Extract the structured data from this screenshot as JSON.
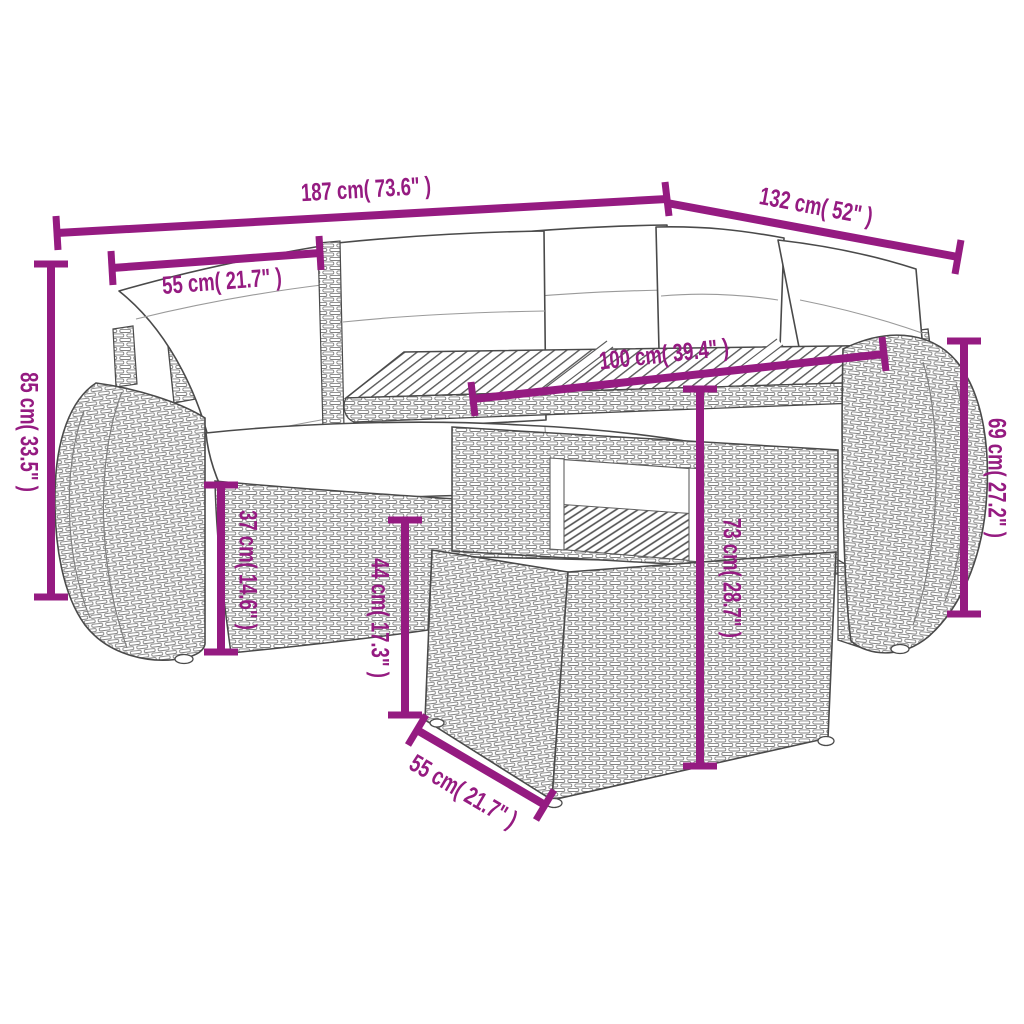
{
  "accent_color": "#951b81",
  "sketch_color": "#4a4a4a",
  "artwork_description": "Grayscale line drawing of a 5-piece poly rattan garden lounge set: corner sofa with back pillows and seat cushions, table with slatted wood top and under-shelf, and a footstool ottoman",
  "dims": {
    "d187": "187 cm( 73.6\" )",
    "d132": "132 cm( 52\" )",
    "d55_top": "55 cm( 21.7\" )",
    "d85": "85 cm( 33.5\" )",
    "d100": "100 cm( 39.4\" )",
    "d69": "69 cm( 27.2\" )",
    "d37": "37 cm( 14.6\" )",
    "d44": "44 cm( 17.3\" )",
    "d73": "73 cm( 28.7\" )",
    "d55_bottom": "55 cm( 21.7\" )"
  }
}
